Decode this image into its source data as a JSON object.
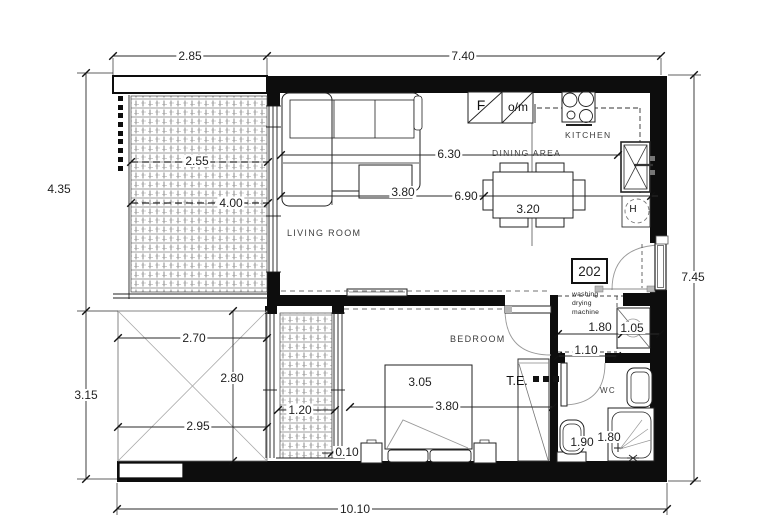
{
  "unit": {
    "number": "202"
  },
  "rooms": {
    "living_room": "LIVING ROOM",
    "kitchen": "KITCHEN",
    "dining_area": "DINING AREA",
    "bedroom": "BEDROOM",
    "wc": "WC"
  },
  "appliances": {
    "fridge": "F",
    "oven_microwave": "o/m",
    "water_heater": "H",
    "washer_note": "washing\ndrying\nmachine",
    "electrical_panel": "T.E."
  },
  "dimensions": {
    "top_balcony_width": "2.85",
    "top_main_width": "7.40",
    "left_upper_height": "4.35",
    "left_lower_height": "3.15",
    "right_height": "7.45",
    "bottom_total_width": "10.10",
    "balcony_inner_width": "2.55",
    "balcony_inner_length": "4.00",
    "living_dining_length": "6.30",
    "living_width": "3.80",
    "interior_width": "6.90",
    "dining_length": "3.20",
    "terrace_top_width": "2.70",
    "terrace_height": "2.80",
    "terrace_bottom_width": "2.95",
    "side_balcony_width": "1.20",
    "wall_gap": "0.10",
    "bedroom_depth": "3.05",
    "bedroom_width": "3.80",
    "hall_width": "1.80",
    "niche_depth": "1.05",
    "hall_depth": "1.10",
    "wc_depth": "1.90",
    "wc_width": "1.80"
  },
  "colors": {
    "wall": "#0d0d0d",
    "line": "#2a2a2a",
    "dim_text": "#1f1f1f",
    "arc": "#999999"
  }
}
